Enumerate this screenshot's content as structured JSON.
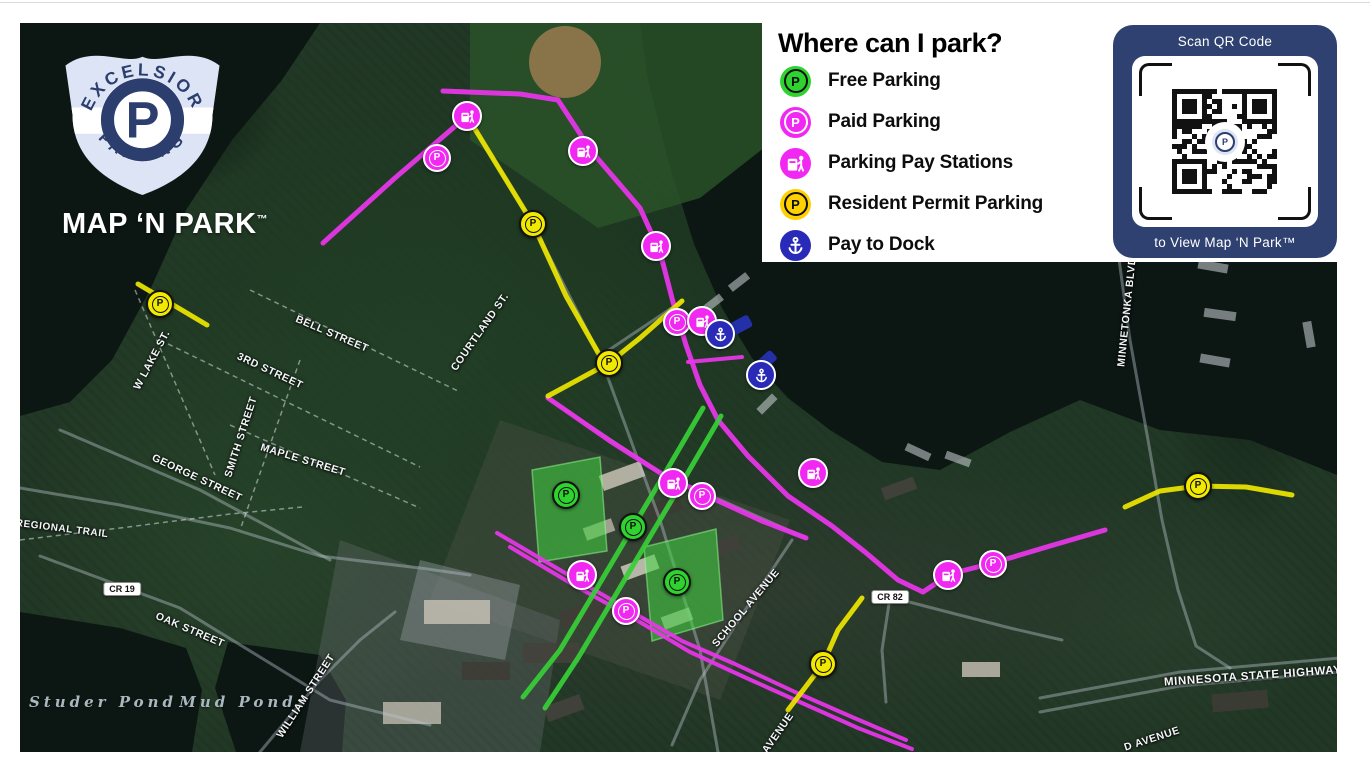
{
  "branding": {
    "badge_top": "EXCELSIOR",
    "badge_bottom": "PARKING",
    "badge_letter": "P",
    "wordmark": "MAP ‘N PARK",
    "trademark": "™"
  },
  "legend": {
    "title": "Where can I park?",
    "items": [
      {
        "id": "free",
        "label": "Free Parking",
        "color": "#2fd32f",
        "glyph": "P",
        "glyph_color": "#0d0d0d"
      },
      {
        "id": "paid",
        "label": "Paid Parking",
        "color": "#f128f1",
        "glyph": "P",
        "glyph_color": "#ffffff"
      },
      {
        "id": "paystation",
        "label": "Parking Pay Stations",
        "color": "#f128f1",
        "glyph": "paystation",
        "glyph_color": "#ffffff"
      },
      {
        "id": "resident",
        "label": "Resident Permit Parking",
        "color": "#ffd100",
        "glyph": "P",
        "glyph_color": "#0d0d0d"
      },
      {
        "id": "dock",
        "label": "Pay to Dock",
        "color": "#2a2ab8",
        "glyph": "anchor",
        "glyph_color": "#ffffff"
      }
    ]
  },
  "qr_panel": {
    "top_label": "Scan QR Code",
    "bottom_label": "to View Map ‘N Park™",
    "panel_color": "#2e4170"
  },
  "colors": {
    "free": "#2fd32f",
    "paid": "#f128f1",
    "resident_map": "#f2e900",
    "dock": "#2a2ab8",
    "route_paid": "#ea35ec",
    "route_free": "#37cf37",
    "route_resident": "#ece400",
    "lot_fill": "rgba(64,214,64,0.55)",
    "lot_edge": "rgba(150,255,150,0.5)",
    "water": "#0c1713",
    "navy_dock": "#2330a8"
  },
  "map": {
    "street_labels": [
      {
        "text": "BELL STREET",
        "x": 332,
        "y": 334,
        "rot": 23
      },
      {
        "text": "3RD STREET",
        "x": 270,
        "y": 371,
        "rot": 25
      },
      {
        "text": "W LAKE ST.",
        "x": 152,
        "y": 360,
        "rot": -62
      },
      {
        "text": "SMITH STREET",
        "x": 241,
        "y": 437,
        "rot": -72
      },
      {
        "text": "MAPLE STREET",
        "x": 303,
        "y": 460,
        "rot": 17
      },
      {
        "text": "GEORGE STREET",
        "x": 197,
        "y": 478,
        "rot": 25
      },
      {
        "text": "COURTLAND ST.",
        "x": 480,
        "y": 332,
        "rot": -55
      },
      {
        "text": "SCHOOL AVENUE",
        "x": 746,
        "y": 608,
        "rot": -50
      },
      {
        "text": "AVENUE",
        "x": 778,
        "y": 733,
        "rot": -55
      },
      {
        "text": "WILLIAM STREET",
        "x": 306,
        "y": 696,
        "rot": -57
      },
      {
        "text": "OAK STREET",
        "x": 190,
        "y": 630,
        "rot": 23
      },
      {
        "text": "REGIONAL TRAIL",
        "x": 62,
        "y": 529,
        "rot": 7,
        "size": 10
      },
      {
        "text": "MINNETONKA BLVD",
        "x": 1127,
        "y": 312,
        "rot": -84
      },
      {
        "text": "MINNESOTA STATE HIGHWAY 7",
        "x": 1258,
        "y": 676,
        "rot": -4,
        "size": 11.5
      },
      {
        "text": "D AVENUE",
        "x": 1152,
        "y": 739,
        "rot": -18
      }
    ],
    "pond_labels": [
      {
        "text": "Studer Pond",
        "x": 63,
        "y": 702
      },
      {
        "text": "Mud Pond",
        "x": 198,
        "y": 702
      }
    ],
    "road_badges": [
      {
        "text": "CR 19",
        "x": 122,
        "y": 589
      },
      {
        "text": "CR 82",
        "x": 890,
        "y": 597
      }
    ],
    "markers": [
      {
        "type": "paid",
        "x": 437,
        "y": 158
      },
      {
        "type": "paid",
        "x": 677,
        "y": 322
      },
      {
        "type": "paid",
        "x": 702,
        "y": 496
      },
      {
        "type": "paid",
        "x": 626,
        "y": 611
      },
      {
        "type": "paid",
        "x": 993,
        "y": 564
      },
      {
        "type": "paystation",
        "x": 467,
        "y": 116
      },
      {
        "type": "paystation",
        "x": 583,
        "y": 151
      },
      {
        "type": "paystation",
        "x": 656,
        "y": 246
      },
      {
        "type": "paystation",
        "x": 702,
        "y": 321
      },
      {
        "type": "paystation",
        "x": 813,
        "y": 473
      },
      {
        "type": "paystation",
        "x": 673,
        "y": 483
      },
      {
        "type": "paystation",
        "x": 582,
        "y": 575
      },
      {
        "type": "paystation",
        "x": 948,
        "y": 575
      },
      {
        "type": "resident",
        "x": 160,
        "y": 304
      },
      {
        "type": "resident",
        "x": 533,
        "y": 224
      },
      {
        "type": "resident",
        "x": 609,
        "y": 363
      },
      {
        "type": "resident",
        "x": 823,
        "y": 664
      },
      {
        "type": "resident",
        "x": 1198,
        "y": 486
      },
      {
        "type": "free",
        "x": 566,
        "y": 495
      },
      {
        "type": "free",
        "x": 633,
        "y": 527
      },
      {
        "type": "free",
        "x": 677,
        "y": 582
      },
      {
        "type": "dock",
        "x": 720,
        "y": 334
      },
      {
        "type": "dock",
        "x": 761,
        "y": 375
      }
    ],
    "routes": [
      {
        "kind": "paid",
        "points": "323,243 395,178 467,116"
      },
      {
        "kind": "paid",
        "points": "443,91 520,94 558,100 592,152 640,208 660,252 673,302 686,345 700,385 718,420 748,456 788,496 832,526 865,552 898,580 923,592 950,574 993,563 1050,546 1105,530"
      },
      {
        "kind": "paid",
        "points": "548,398 610,441 662,474 714,499 762,521 806,538"
      },
      {
        "kind": "paid",
        "points": "497,533 560,570 622,606 682,641 735,664 795,692 852,717 906,740",
        "width": 4
      },
      {
        "kind": "paid",
        "points": "510,547 572,584 633,618 690,652 742,676 802,703 858,728 912,749",
        "width": 4
      },
      {
        "kind": "paid",
        "points": "688,362 742,357",
        "width": 4
      },
      {
        "kind": "resident",
        "points": "138,284 207,325"
      },
      {
        "kind": "resident",
        "points": "467,116 500,170 533,224 566,296 600,356"
      },
      {
        "kind": "resident",
        "points": "682,301 640,338 609,363 548,396"
      },
      {
        "kind": "resident",
        "points": "862,598 838,630 823,664 788,710"
      },
      {
        "kind": "resident",
        "points": "1125,507 1160,491 1198,486 1246,487 1292,495"
      },
      {
        "kind": "free",
        "points": "703,408 668,468 633,527 597,588 560,650 523,697"
      },
      {
        "kind": "free",
        "points": "721,416 686,476 651,535 615,596 578,658 545,708"
      }
    ],
    "lots": [
      {
        "points": "532,470 600,457 607,551 539,562"
      },
      {
        "points": "644,547 716,529 723,620 652,641"
      }
    ],
    "water": [
      {
        "points": "640,23 1337,23 1337,475 1250,440 1160,430 1080,400 1010,432 940,470 882,462 830,430 788,398 752,358 722,308 694,244 668,160 648,80"
      },
      {
        "points": "20,23 320,23 282,80 232,140 186,210 150,290 112,360 70,402 20,416"
      },
      {
        "points": "20,612 120,628 186,648 202,690 192,752 20,752"
      },
      {
        "points": "215,688 228,642 320,655 346,700 342,752 236,752"
      }
    ],
    "parks": [
      {
        "points": "470,23 830,23 802,118 700,198 598,228 470,140",
        "fill": "#2a5429"
      }
    ],
    "urban": [
      {
        "points": "500,420 790,520 720,700 430,600",
        "fill": "#55564c",
        "op": 0.32
      },
      {
        "points": "340,540 560,620 540,752 300,752",
        "fill": "#70757a",
        "op": 0.3
      },
      {
        "points": "420,560 520,585 505,660 400,640",
        "fill": "#8e949a",
        "op": 0.45
      }
    ],
    "roads_main": [
      "20,488 120,505 230,528 320,556 420,568 470,575",
      "40,556 180,608 330,700 430,725",
      "467,116 533,224 600,356 660,520 700,650 718,752",
      "1040,698 1180,672 1340,658",
      "1040,712 1180,686 1340,672",
      "1118,252 1130,340 1148,440 1162,520 1178,590 1196,646 1230,668",
      "792,540 744,612 700,680 672,745",
      "260,752 320,680 360,640 395,612",
      "60,430 200,490 330,560",
      "890,597 940,610 1010,628 1062,640",
      "890,597 882,650 886,702",
      "548,398 662,474 806,538",
      "600,356 682,301"
    ],
    "roads_dashed": [
      "250,290 460,392",
      "160,340 420,467",
      "230,425 420,508",
      "300,360 240,530",
      "135,290 215,475",
      "20,540 120,528 230,514 302,507"
    ],
    "docks": [
      {
        "x": 1196,
        "y": 78,
        "w": 30,
        "h": 9,
        "r": 10
      },
      {
        "x": 1200,
        "y": 120,
        "w": 34,
        "h": 9,
        "r": 8
      },
      {
        "x": 1196,
        "y": 168,
        "w": 30,
        "h": 9,
        "r": 12
      },
      {
        "x": 1202,
        "y": 215,
        "w": 34,
        "h": 9,
        "r": 8
      },
      {
        "x": 1198,
        "y": 262,
        "w": 30,
        "h": 9,
        "r": 10
      },
      {
        "x": 1204,
        "y": 310,
        "w": 32,
        "h": 9,
        "r": 8
      },
      {
        "x": 1200,
        "y": 356,
        "w": 30,
        "h": 9,
        "r": 10
      },
      {
        "x": 905,
        "y": 448,
        "w": 26,
        "h": 8,
        "r": 25
      },
      {
        "x": 945,
        "y": 455,
        "w": 26,
        "h": 8,
        "r": 20
      },
      {
        "x": 700,
        "y": 300,
        "w": 24,
        "h": 8,
        "r": -38
      },
      {
        "x": 728,
        "y": 278,
        "w": 22,
        "h": 8,
        "r": -38
      },
      {
        "x": 756,
        "y": 400,
        "w": 22,
        "h": 8,
        "r": -45
      },
      {
        "x": 1300,
        "y": 90,
        "w": 26,
        "h": 9,
        "r": 5
      },
      {
        "x": 1296,
        "y": 330,
        "w": 26,
        "h": 9,
        "r": 80
      }
    ],
    "navy_docks": [
      {
        "x": 737,
        "y": 327,
        "w": 30,
        "h": 13,
        "r": -28
      },
      {
        "x": 765,
        "y": 362,
        "w": 24,
        "h": 12,
        "r": -42
      }
    ],
    "buildings": [
      [
        600,
        468,
        44,
        16,
        -20,
        "#c8c2b4"
      ],
      [
        646,
        500,
        36,
        16,
        -20,
        "#3c3a34"
      ],
      [
        584,
        523,
        30,
        13,
        -20,
        "#b5afa2"
      ],
      [
        700,
        541,
        40,
        15,
        -20,
        "#41403a"
      ],
      [
        622,
        560,
        36,
        15,
        -20,
        "#cfcabd"
      ],
      [
        560,
        604,
        48,
        18,
        -20,
        "#3f3d37"
      ],
      [
        662,
        612,
        30,
        13,
        -20,
        "#bdb7aa"
      ],
      [
        523,
        643,
        56,
        20,
        0,
        "#44423c"
      ],
      [
        424,
        600,
        66,
        24,
        0,
        "#c3beb2"
      ],
      [
        462,
        662,
        48,
        18,
        0,
        "#3e3c36"
      ],
      [
        383,
        702,
        58,
        22,
        0,
        "#b9b4a8"
      ],
      [
        545,
        700,
        38,
        16,
        -20,
        "#45433d"
      ],
      [
        1212,
        692,
        56,
        18,
        -5,
        "#3e3c36"
      ],
      [
        962,
        662,
        38,
        15,
        0,
        "#c0bbae"
      ],
      [
        882,
        482,
        34,
        13,
        -20,
        "#45433d"
      ]
    ],
    "field": {
      "x": 565,
      "y": 62,
      "r": 36,
      "fill": "#9a7b50"
    }
  }
}
